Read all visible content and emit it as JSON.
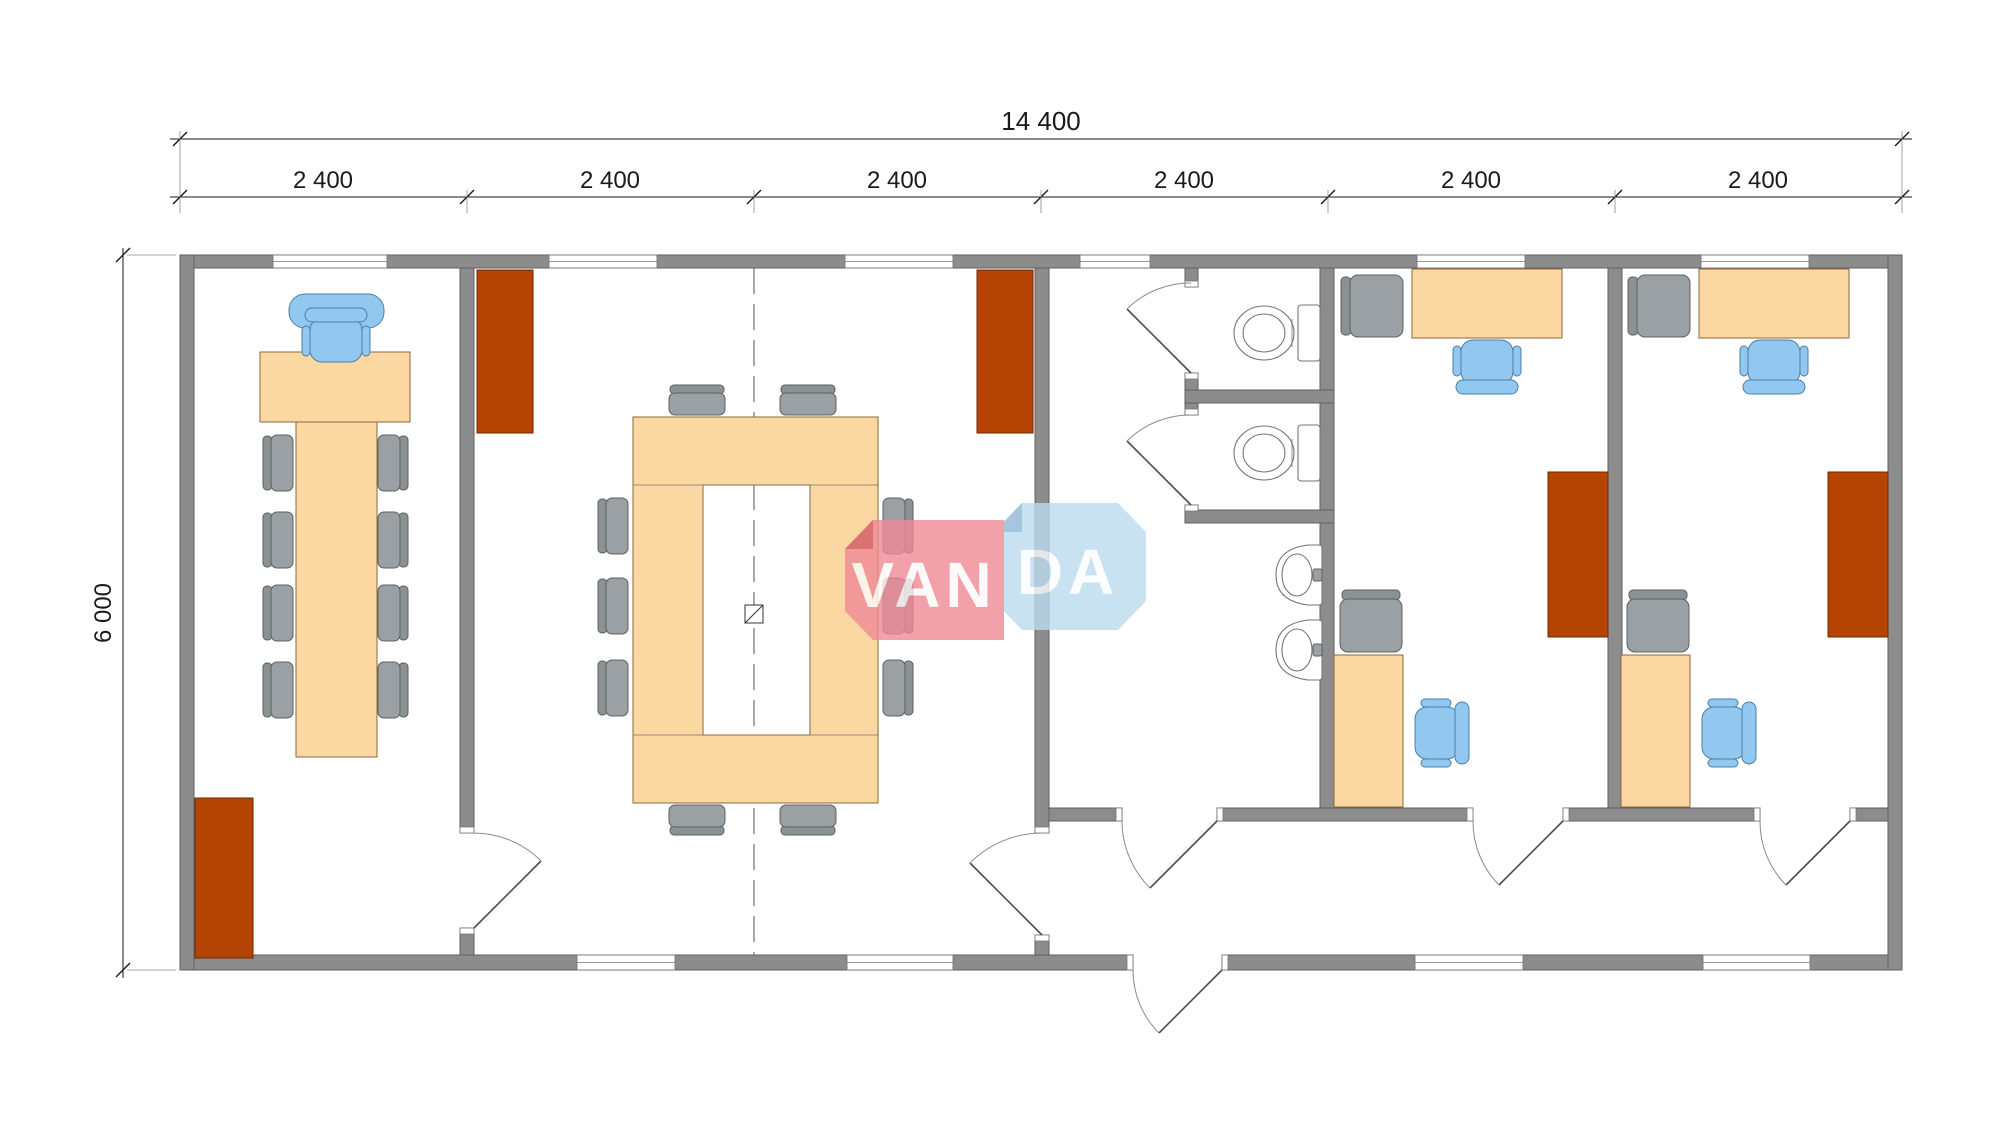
{
  "drawing": {
    "total_width_label": "14 400",
    "module_labels": [
      "2 400",
      "2 400",
      "2 400",
      "2 400",
      "2 400",
      "2 400"
    ],
    "depth_label": "6 000"
  },
  "watermark": {
    "name": "VANDA",
    "text_left": "VAN",
    "text_right": "DA"
  },
  "colors": {
    "wall": "#8c8c8c",
    "wall_edge": "#5f5f5f",
    "furniture": "#fbd7a2",
    "furniture_edge": "#8a6a3c",
    "cabinet": "#b54304",
    "cabinet_edge": "#6f2a00",
    "chair_blue": "#92c7ef",
    "chair_blue_edge": "#4a7fa8",
    "chair_gray": "#9aa0a3",
    "chair_gray_dark": "#8c9194",
    "chair_gray_edge": "#5a6064",
    "fixture_edge": "#767676",
    "line": "#1a1a1a",
    "door": "#4d4d4d",
    "door_arc": "#8a8a8a",
    "centerline": "#555555",
    "wm_red": "#ef8a96",
    "wm_red_dark": "#d25a66",
    "wm_blue": "#bcdcf0",
    "wm_blue_dark": "#8fb8d6",
    "wm_text": "#ffffff"
  }
}
